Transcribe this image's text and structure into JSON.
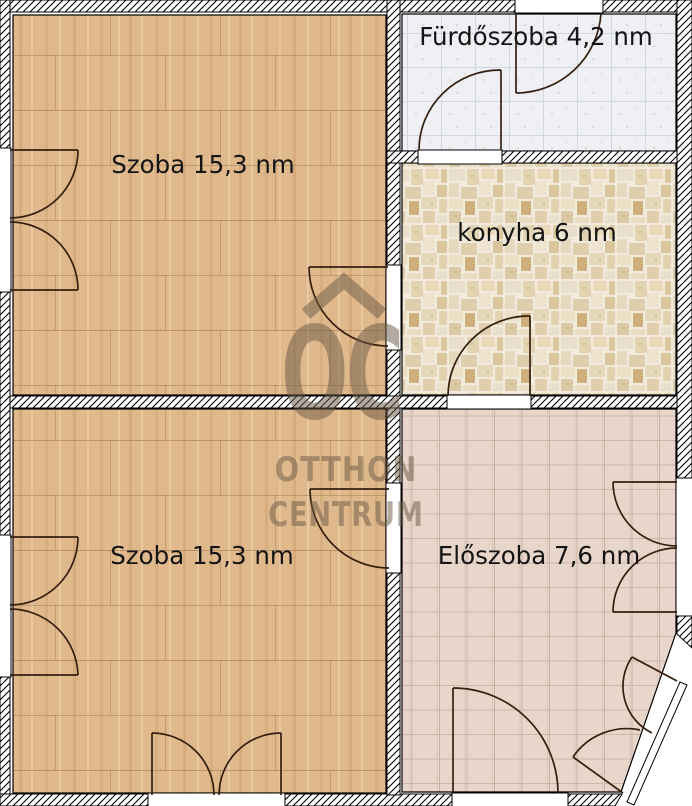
{
  "rooms": {
    "szoba_top": {
      "label": "Szoba 15,3 nm",
      "area_nm": "15,3",
      "floor_color": "#dfb88c"
    },
    "furdoszoba": {
      "label": "Fürdőszoba 4,2 nm",
      "area_nm": "4,2",
      "floor_color": "#eef0f4"
    },
    "konyha": {
      "label": "konyha 6 nm",
      "area_nm": "6",
      "floor_color": "#f1ebdd"
    },
    "szoba_bottom": {
      "label": "Szoba 15,3 nm",
      "area_nm": "15,3",
      "floor_color": "#dfb88c"
    },
    "eloszoba": {
      "label": "Előszoba 7,6 nm",
      "area_nm": "7,6",
      "floor_color": "#e8d6ca"
    }
  },
  "watermark": {
    "logo_text": "OC",
    "line1": "OTTHON",
    "line2": "CENTRUM",
    "color": "#6a5a45"
  },
  "colors": {
    "background": "#ffffff",
    "wall_hatch_line": "#000000",
    "door_line": "#35200f",
    "label_text": "#141414"
  }
}
